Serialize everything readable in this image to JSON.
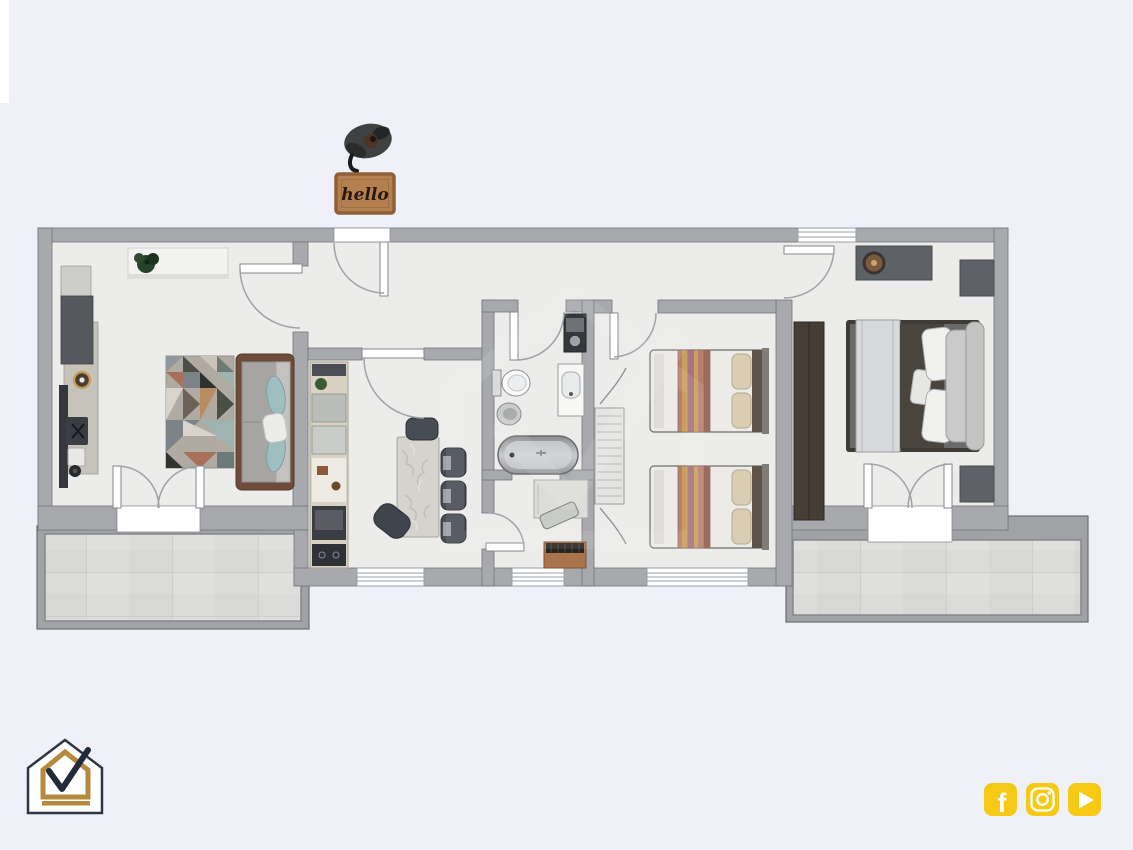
{
  "page": {
    "background_color": "#F0F1F8"
  },
  "doormat": {
    "text": "hello",
    "bg_color": "#B5804F",
    "border_color": "#8E6138",
    "text_color": "#2A1710"
  },
  "logo": {
    "name": "house-check-logo",
    "outline_color": "#2E3547",
    "accent_color": "#B5893E"
  },
  "social_bar": {
    "accent_color": "#F6C915",
    "glyph_color": "#FFFFFF",
    "icons": [
      {
        "name": "facebook-icon"
      },
      {
        "name": "instagram-icon"
      },
      {
        "name": "youtube-icon"
      }
    ]
  },
  "floorplan": {
    "wall_color": "#A7A9AD",
    "wall_outline_color": "#74767B",
    "floor_color": "#ECECEA",
    "terrace_tile_color": "#DBDBD9",
    "door_arc_color": "#9FA3A7",
    "rooms": [
      "living-room-with-kitchen",
      "entry-hall",
      "dining-room",
      "bathroom",
      "study-nook",
      "corridor",
      "twin-bedroom",
      "master-bedroom",
      "terrace-left",
      "terrace-right"
    ]
  }
}
